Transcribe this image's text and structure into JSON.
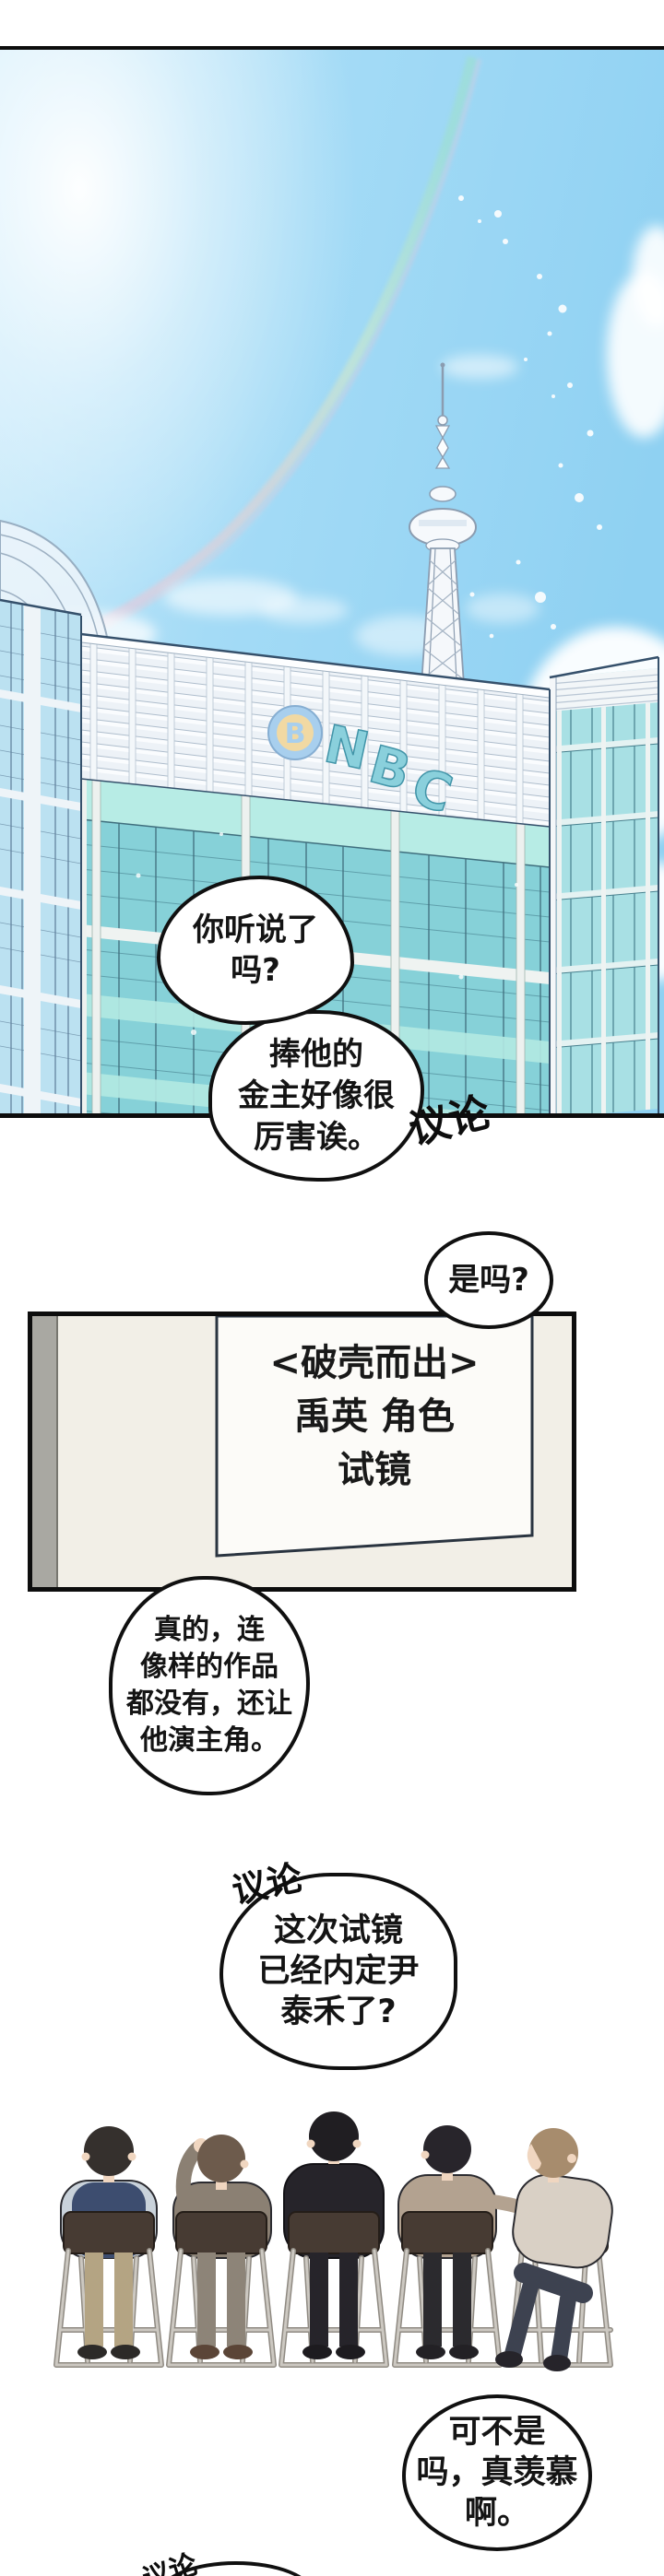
{
  "meta": {
    "kind": "webtoon-comic-page",
    "language": "zh"
  },
  "building": {
    "logo_badge_letter": "B",
    "logo_letters": [
      "N",
      "B",
      "C"
    ]
  },
  "speech": {
    "b1": {
      "lines": [
        "你听说了",
        "吗?"
      ]
    },
    "b2": {
      "lines": [
        "捧他的",
        "金主好像很",
        "厉害诶。"
      ]
    },
    "sfx1": "议论",
    "bq": {
      "lines": [
        "是吗?"
      ]
    },
    "sign": {
      "lines": [
        "<破壳而出>",
        "禹英 角色",
        "试镜"
      ]
    },
    "b3": {
      "lines": [
        "真的，连",
        "像样的作品",
        "都没有，还让",
        "他演主角。"
      ]
    },
    "sfx2": "议论",
    "b4": {
      "lines": [
        "这次试镜",
        "已经内定尹",
        "泰禾了?"
      ]
    },
    "b5": {
      "lines": [
        "可不是",
        "吗，真羡慕",
        "啊。"
      ]
    },
    "sfx3": "议论"
  },
  "palette": {
    "sky_blue": "#9bd7f4",
    "sky_light": "#cdecfb",
    "sun_glow": "#ffffff",
    "rainbow_green": "#9fe2c4",
    "rainbow_pink": "#f2c4d4",
    "glass_teal": "#86d1d8",
    "glass_mint": "#b7ece5",
    "glass_blue": "#bbe1f1",
    "lattice_white": "#edf2f7",
    "logo_badge_blue": "#a8cfee",
    "logo_badge_tan": "#f1d9a3",
    "logo_letters_teal": "#8ad0dc",
    "panel_border_black": "#101010",
    "wall_cream": "#f2efe7",
    "wall_strip_gray": "#a9a8a2",
    "chair_seat_brown": "#473b33",
    "chair_metal_gray": "#ccc8c1",
    "skin": "#f0d6c0",
    "p1_vest_navy": "#3d4d6f",
    "p2_suit_taupe": "#8b8073",
    "p3_suit_black": "#26242a",
    "p4_sweater_tan": "#b3a290",
    "p5_top_cream": "#d9d0c5",
    "p5_jeans": "#3d4250"
  }
}
